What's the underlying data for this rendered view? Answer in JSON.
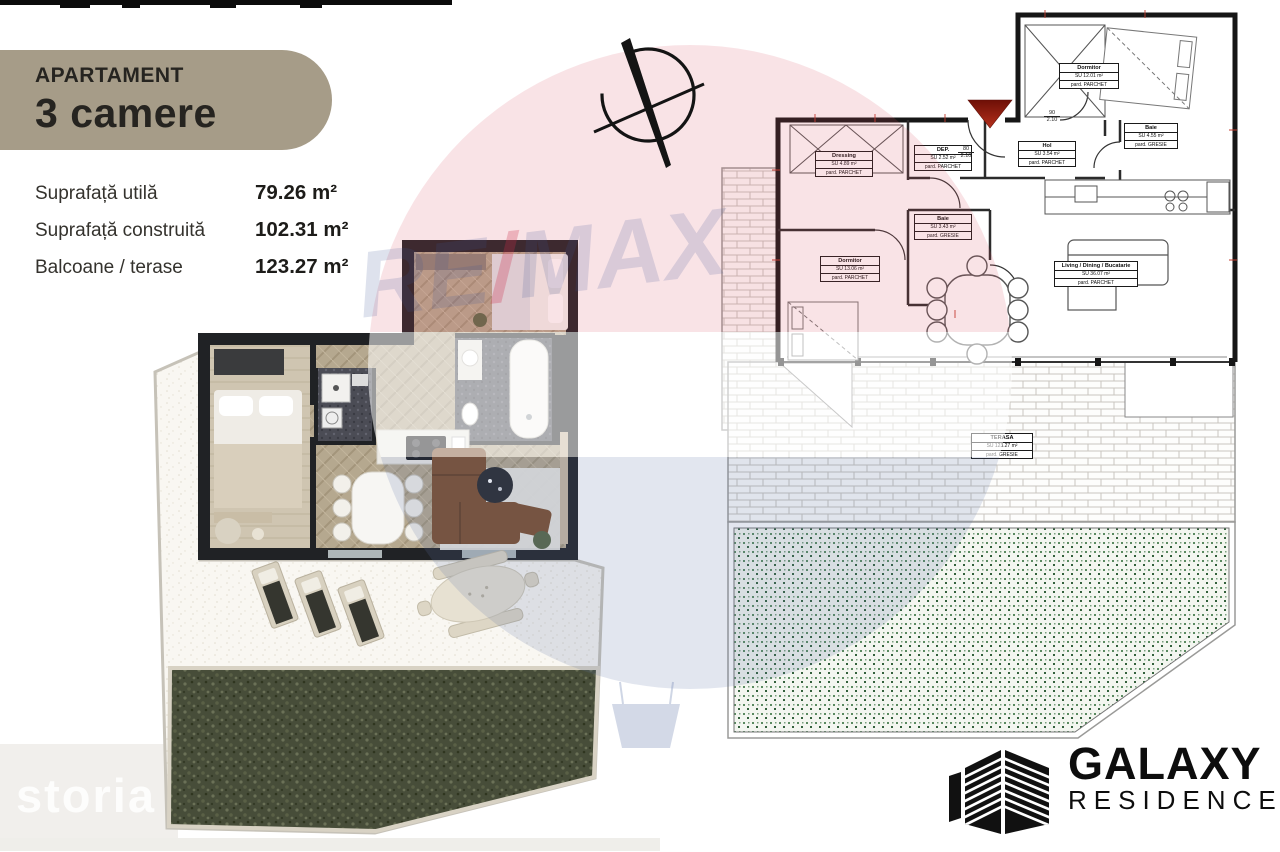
{
  "header": {
    "label": "APARTAMENT",
    "value": "3 camere"
  },
  "specs": [
    {
      "label": "Suprafață utilă",
      "value": "79.26 m²"
    },
    {
      "label": "Suprafață construită",
      "value": "102.31 m²"
    },
    {
      "label": "Balcoane / terase",
      "value": "123.27 m²"
    }
  ],
  "compass": {
    "icon": "north-compass-icon"
  },
  "watermarks": {
    "remax": {
      "re": "RE",
      "slash": "/",
      "max": "MAX"
    },
    "storia": "storia"
  },
  "technical_plan": {
    "rooms": [
      {
        "name": "Dressing",
        "area": "SU 4.89 m²",
        "finish": "pard. PARCHET"
      },
      {
        "name": "DEP.",
        "area": "SU 2.52 m²",
        "finish": "pard. PARCHET"
      },
      {
        "name": "Hol",
        "area": "SU 3.54 m²",
        "finish": "pard. PARCHET"
      },
      {
        "name": "Baie",
        "area": "SU 3.43 m²",
        "finish": "pard. GRESIE"
      },
      {
        "name": "Dormitor",
        "area": "SU 13.06 m²",
        "finish": "pard. PARCHET"
      },
      {
        "name": "Dormitor",
        "area": "SU 12.01 m²",
        "finish": "pard. PARCHET"
      },
      {
        "name": "Baie",
        "area": "SU 4.55 m²",
        "finish": "pard. GRESIE"
      },
      {
        "name": "Living / Dining / Bucatarie",
        "area": "SU 36.07 m²",
        "finish": "pard. PARCHET"
      },
      {
        "name": "TERASA",
        "area": "SU 123.27 m²",
        "finish": "pard. GRESIE"
      }
    ],
    "door_tags": [
      {
        "width": "80",
        "height": "2.10"
      },
      {
        "width": "90",
        "height": "2.10"
      }
    ]
  },
  "branding": {
    "title": "GALAXY",
    "subtitle": "RESIDENCE",
    "icon": "building-icon"
  },
  "colors": {
    "badge": "#a69c88",
    "walls_3d": "#202225",
    "remax_red": "#d85064",
    "remax_blue": "#6076a8",
    "garden_green": "#474d39",
    "terrace_dots_green": "#5a8a60",
    "entrance_marker": "#8e1a10"
  }
}
